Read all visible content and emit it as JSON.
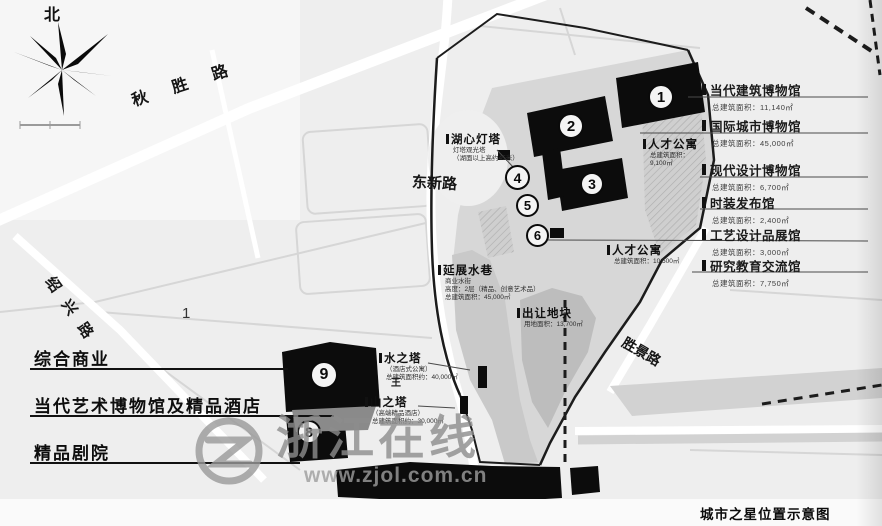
{
  "page": {
    "caption": "城市之星位置示意图"
  },
  "compass": {
    "label": "北"
  },
  "watermark": {
    "title": "浙江在线",
    "url": "www.zjol.com.cn"
  },
  "roads": [
    {
      "label": "秋胜路"
    },
    {
      "label": "东新路"
    },
    {
      "label": "绍兴路"
    },
    {
      "label": "胜景路"
    }
  ],
  "markers": [
    "1",
    "2",
    "3",
    "4",
    "5",
    "6",
    "8",
    "9"
  ],
  "right_legend": [
    {
      "name": "当代建筑博物馆",
      "area": "总建筑面积：11,140㎡"
    },
    {
      "name": "国际城市博物馆",
      "area": "总建筑面积：45,000㎡"
    },
    {
      "name": "现代设计博物馆",
      "area": "总建筑面积：6,700㎡"
    },
    {
      "name": "时装发布馆",
      "area": "总建筑面积：2,400㎡"
    },
    {
      "name": "工艺设计品展馆",
      "area": "总建筑面积：3,000㎡"
    },
    {
      "name": "研究教育交流馆",
      "area": "总建筑面积：7,750㎡"
    }
  ],
  "left_legend": [
    {
      "name": "综合商业"
    },
    {
      "name": "当代艺术博物馆及精品酒店"
    },
    {
      "name": "精品剧院"
    }
  ],
  "site_labels": [
    {
      "name": "湖心灯塔",
      "lines": [
        "灯塔观光塔",
        "（湖面以上高约45米）"
      ]
    },
    {
      "name": "人才公寓",
      "lines": [
        "总建筑面积：",
        "9,100㎡"
      ]
    },
    {
      "name": "人才公寓",
      "lines": [
        "总建筑面积：10,500㎡"
      ]
    },
    {
      "name": "延展水巷",
      "lines": [
        "商业水街",
        "高度：2层（精品、创意艺术品）",
        "总建筑面积：45,000㎡"
      ]
    },
    {
      "name": "出让地块",
      "lines": [
        "用地面积：13,700㎡"
      ]
    },
    {
      "name": "水之塔",
      "lines": [
        "（酒店式公寓）",
        "总建筑面积约：40,000㎡"
      ]
    },
    {
      "name": "山之塔",
      "lines": [
        "（高端精品酒店）",
        "总建筑面积约：30,000㎡"
      ]
    }
  ],
  "misc": {
    "region_number": "1",
    "small_mark": "王"
  }
}
